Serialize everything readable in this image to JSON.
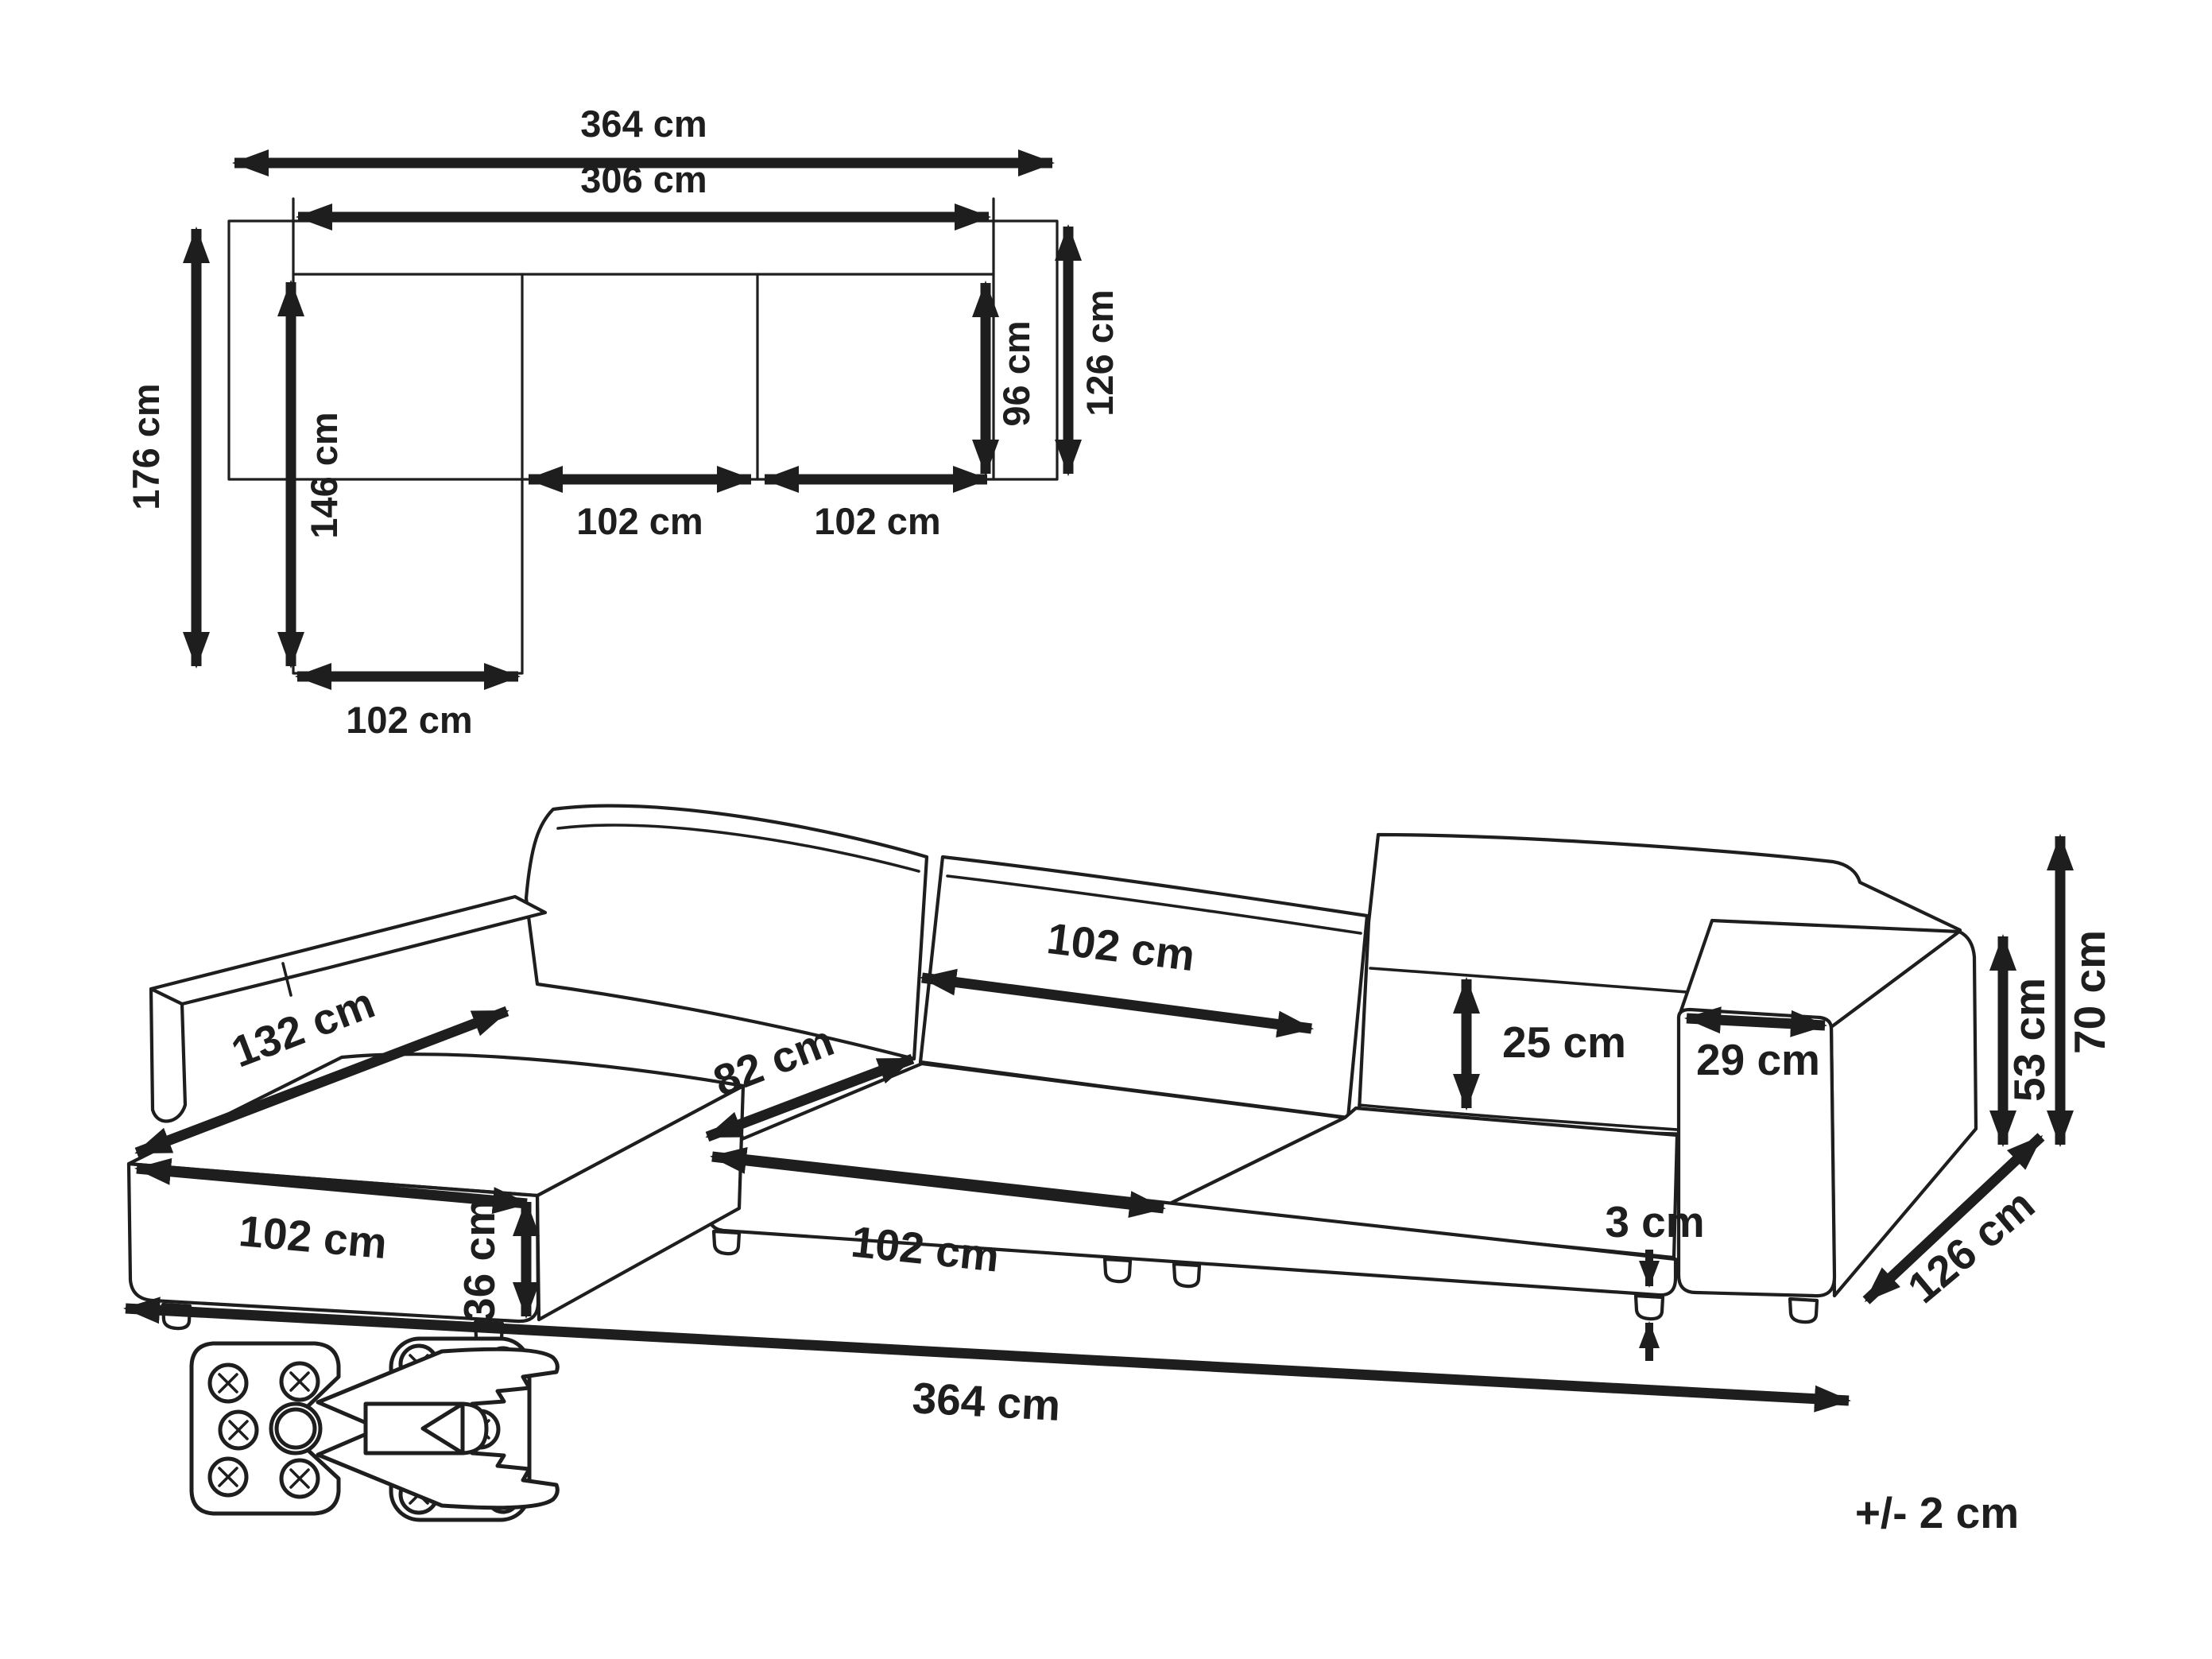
{
  "meta": {
    "background": "#ffffff",
    "line_color": "#1e1e1e",
    "drawing_type": "sofa dimension diagram"
  },
  "top_view": {
    "total_width": "364 cm",
    "inner_width": "306 cm",
    "total_depth": "176 cm",
    "chaise_depth": "146 cm",
    "seat_depth": "96 cm",
    "right_depth": "126 cm",
    "mid_seat_width": "102 cm",
    "right_seat_width": "102 cm",
    "chaise_width": "102 cm"
  },
  "perspective_view": {
    "chaise_length": "132 cm",
    "chaise_width": "102 cm",
    "seat_depth": "82 cm",
    "seat_width": "102 cm",
    "backrest_width": "102 cm",
    "headrest_height": "25 cm",
    "armrest_width": "29 cm",
    "seat_height": "36 cm",
    "armrest_height": "53 cm",
    "total_height": "70 cm",
    "leg_height": "3 cm",
    "side_depth": "126 cm",
    "total_width": "364 cm"
  },
  "icons": {
    "connector": "sofa-connector-bracket-icon"
  },
  "note": {
    "tolerance": "+/- 2 cm"
  }
}
